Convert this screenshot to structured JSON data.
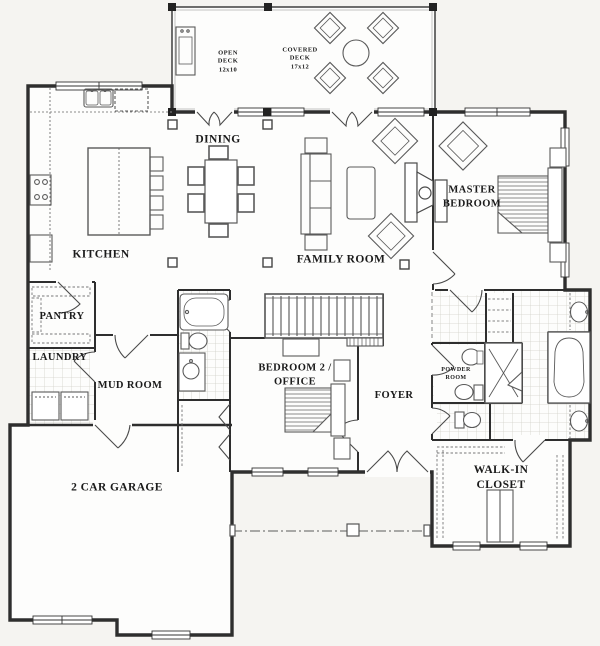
{
  "colors": {
    "background": "#f5f4f1",
    "room_fill": "#fdfdfc",
    "walls": "#2e2e2e",
    "furniture_line": "#5a5a5a",
    "tile_line": "#d2d1ca",
    "label_text": "#1b1b1b"
  },
  "rooms": {
    "open_deck": {
      "label": "OPEN\nDECK\n12x10"
    },
    "covered_deck": {
      "label": "COVERED\nDECK\n17x12"
    },
    "dining": {
      "label": "DINING"
    },
    "kitchen": {
      "label": "KITCHEN"
    },
    "family_room": {
      "label": "FAMILY ROOM"
    },
    "master_bedroom": {
      "label": "MASTER\nBEDROOM"
    },
    "pantry": {
      "label": "PANTRY"
    },
    "laundry": {
      "label": "LAUNDRY"
    },
    "mud_room": {
      "label": "MUD ROOM"
    },
    "bedroom2_office": {
      "label": "BEDROOM 2 /\nOFFICE"
    },
    "foyer": {
      "label": "FOYER"
    },
    "powder_room": {
      "label": "POWDER\nROOM"
    },
    "garage": {
      "label": "2 CAR GARAGE"
    },
    "walk_in_closet": {
      "label": "WALK-IN CLOSET"
    }
  }
}
